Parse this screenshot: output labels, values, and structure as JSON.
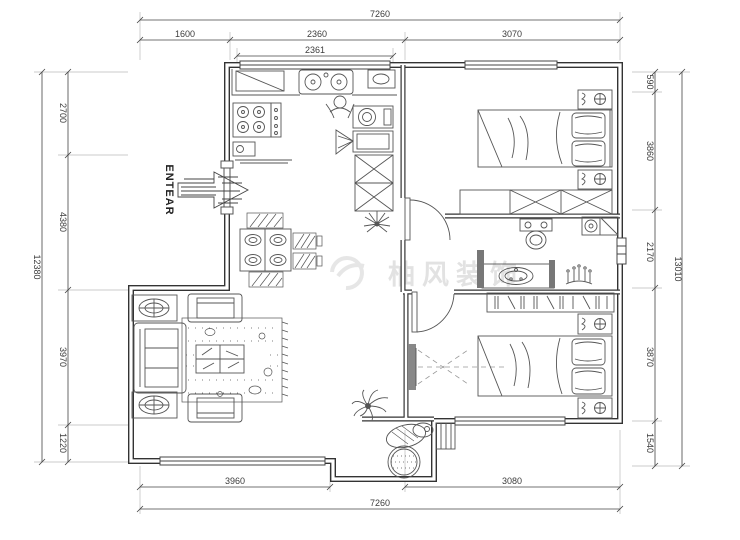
{
  "page": {
    "background": "#ffffff"
  },
  "entrance": {
    "label": "ENTEAR"
  },
  "watermark": {
    "text": "柚风装饰"
  },
  "dimensions": {
    "top": {
      "overall": "7260",
      "segments": [
        "1600",
        "2360",
        "3070"
      ],
      "window": "2361"
    },
    "bottom": {
      "segments": [
        "3960",
        "3080"
      ],
      "overall": "7260"
    },
    "left": {
      "overall": "12380",
      "segments": [
        "2700",
        "4380",
        "3970",
        "1220"
      ]
    },
    "right": {
      "overall": "13010",
      "segments": [
        "590",
        "3860",
        "2170",
        "3870",
        "1540"
      ]
    }
  },
  "colors": {
    "wall": "#333333",
    "furniture": "#555555",
    "dimension": "#444444",
    "watermark": "#cccccc"
  },
  "icons": [
    "entrance-arrow-icon",
    "stove-icon",
    "kitchen-sink-icon",
    "washing-machine-icon",
    "x-cabinet-icon",
    "plant-icon",
    "dining-table-icon",
    "chair-icon",
    "sofa-icon",
    "armchair-icon",
    "coffee-table-icon",
    "rug-icon",
    "side-table-icon",
    "bed-icon",
    "pillow-icon",
    "nightstand-lamp-icon",
    "wardrobe-icon",
    "door-swing-icon",
    "toilet-icon",
    "corner-sink-icon",
    "vanity-basin-icon",
    "candelabra-icon",
    "hanger-closet-icon",
    "tv-icon",
    "palm-plant-icon",
    "balcony-basin-icon",
    "round-rug-icon",
    "steps-icon",
    "window-icon"
  ]
}
